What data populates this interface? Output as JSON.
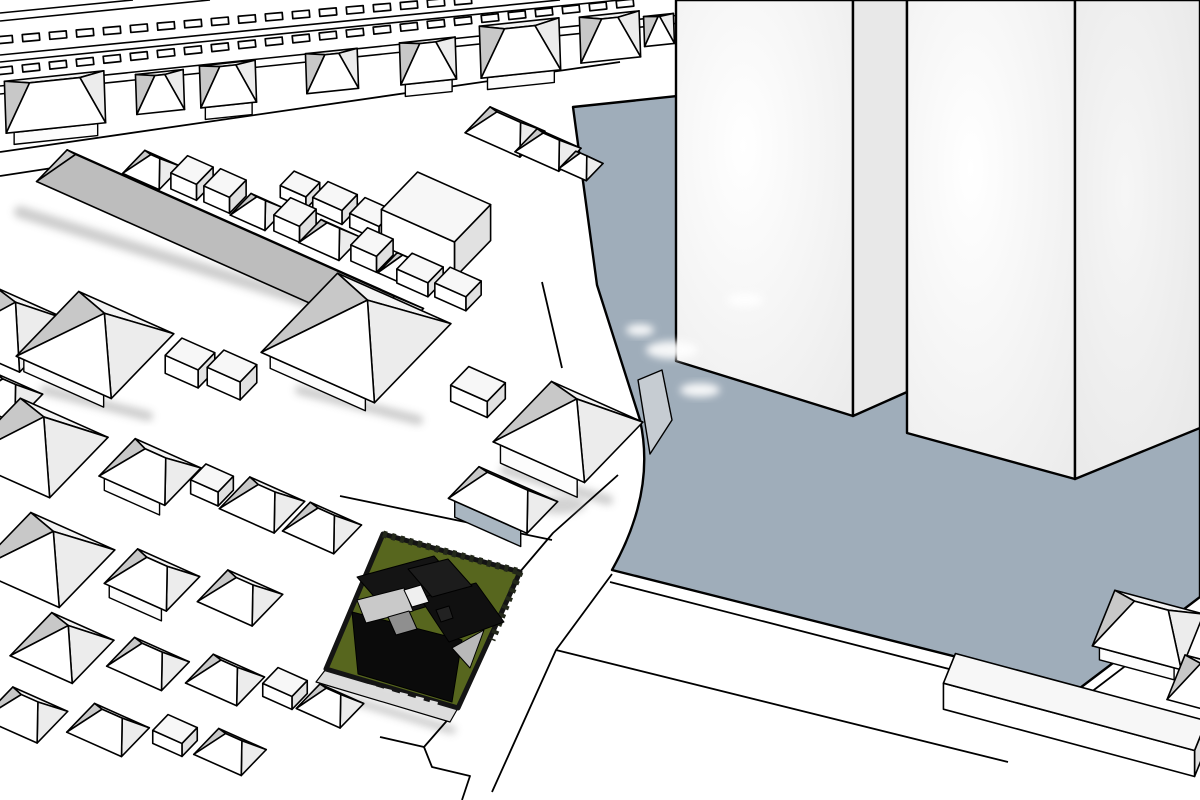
{
  "meta": {
    "kind": "3d-site-model-rendering",
    "description_visible_text": ""
  },
  "palette": {
    "background": "#ffffff",
    "line": "#000000",
    "roof_white": "#ffffff",
    "roof_back": "#f3f3f3",
    "roof_left_shade": "#c8c8c8",
    "roof_right_shade": "#ececec",
    "roof_gray_front": "#bdbdbd",
    "wall_white": "#fcfcfc",
    "wall_blue": "#a9b6c1",
    "box_top": "#f7f7f7",
    "box_front": "#ffffff",
    "box_side": "#e1e1e1",
    "plot_blue": "#9fadba",
    "apron_gray": "#c6ccd2",
    "lot_green": "#57661e",
    "lot_border": "#141414",
    "lot_curb": "#dcdcdc",
    "tower_bright_a": "#ffffff",
    "tower_bright_b": "#ececec",
    "tower_side_a": "#f6f6f6",
    "tower_side_b": "#e6e6e6",
    "tower_flat_side": "#e8e8e8",
    "shadow_gray": "#8f8f8f",
    "dark_building": "#0b0b0b"
  },
  "scene": {
    "width": 1200,
    "height": 800,
    "zones": {
      "R": {
        "p": -6,
        "q": 88
      },
      "M": {
        "p": 24,
        "q": 134
      },
      "L": {
        "p": 15,
        "q": 112
      }
    },
    "railway": {
      "rails": [
        [
          0,
          13,
          133,
          0
        ],
        [
          0,
          21,
          210,
          0
        ],
        [
          0,
          55,
          560,
          0
        ],
        [
          0,
          62,
          620,
          0
        ],
        [
          0,
          86,
          690,
          14
        ],
        [
          0,
          94,
          690,
          22
        ]
      ],
      "tie_rows": [
        {
          "x0": 4,
          "x1": 470,
          "step": 27,
          "y0": 40,
          "slope": -0.085,
          "w": 17,
          "h": 7,
          "ang": -5
        },
        {
          "x0": 4,
          "x1": 648,
          "step": 27,
          "y0": 71,
          "slope": -0.108,
          "w": 17,
          "h": 7,
          "ang": -6
        }
      ]
    },
    "plot": {
      "path": "M573,107 L1200,41 L1200,597 L1080,688 L612,570 Q656,492 640,420 L597,285 Z"
    },
    "apron": [
      [
        638,
        380
      ],
      [
        662,
        370
      ],
      [
        672,
        420
      ],
      [
        650,
        454
      ]
    ],
    "towers": [
      {
        "pts": [
          [
            676,
            0
          ],
          [
            853,
            0
          ],
          [
            853,
            416
          ],
          [
            676,
            361
          ]
        ],
        "fill": "grad_front"
      },
      {
        "pts": [
          [
            853,
            0
          ],
          [
            907,
            0
          ],
          [
            907,
            392
          ],
          [
            853,
            416
          ]
        ],
        "fill": "flat_side"
      },
      {
        "pts": [
          [
            907,
            0
          ],
          [
            1075,
            0
          ],
          [
            1075,
            479
          ],
          [
            907,
            433
          ]
        ],
        "fill": "grad_front"
      },
      {
        "pts": [
          [
            1075,
            0
          ],
          [
            1200,
            0
          ],
          [
            1200,
            428
          ],
          [
            1075,
            479
          ]
        ],
        "fill": "grad_side"
      }
    ],
    "street_lines": [
      "M0,152 L620,62",
      "M0,176 L85,163 L88,195",
      "M542,282 L562,368",
      "M618,475 L553,533 L519,573",
      "M458,708 L424,747 L432,767 L470,776 L462,800",
      "M380,737 L424,747",
      "M612,574 L556,650 L492,792",
      "M556,650 L1008,762",
      "M610,582 L1070,700",
      "M340,496 L552,540",
      "M1086,696 L1196,612"
    ],
    "shadow_lines": [
      [
        20,
        212,
        400,
        330,
        12
      ],
      [
        45,
        390,
        148,
        416,
        10
      ],
      [
        300,
        390,
        418,
        420,
        10
      ],
      [
        505,
        470,
        608,
        500,
        10
      ],
      [
        318,
        690,
        452,
        730,
        8
      ]
    ],
    "white_blobs": [
      [
        672,
        350,
        26,
        9
      ],
      [
        745,
        300,
        18,
        7
      ],
      [
        700,
        390,
        20,
        7
      ],
      [
        640,
        330,
        14,
        6
      ]
    ],
    "gray_blobs": [
      [
        560,
        505,
        26,
        9
      ]
    ],
    "houses": [
      [
        55,
        102,
        50,
        26,
        14,
        "hip",
        "R",
        1,
        ""
      ],
      [
        160,
        92,
        24,
        20,
        11,
        "hip",
        "R",
        0,
        ""
      ],
      [
        228,
        84,
        28,
        21,
        12,
        "hip",
        "R",
        1,
        ""
      ],
      [
        332,
        71,
        26,
        20,
        11,
        "hip",
        "R",
        0,
        ""
      ],
      [
        428,
        61,
        28,
        21,
        12,
        "hip",
        "R",
        1,
        ""
      ],
      [
        520,
        48,
        40,
        26,
        13,
        "hip",
        "R",
        1,
        ""
      ],
      [
        610,
        37,
        30,
        23,
        12,
        "hip",
        "R",
        0,
        ""
      ],
      [
        659,
        30,
        15,
        15,
        9,
        "hip",
        "R",
        0,
        ""
      ],
      [
        152,
        170,
        20,
        16,
        10,
        "hip",
        "M",
        0,
        ""
      ],
      [
        192,
        186,
        14,
        12,
        16,
        "box",
        "M",
        0,
        ""
      ],
      [
        225,
        199,
        14,
        12,
        16,
        "box",
        "M",
        0,
        ""
      ],
      [
        258,
        212,
        19,
        15,
        10,
        "hip",
        "M",
        0,
        ""
      ],
      [
        295,
        228,
        14,
        12,
        16,
        "box",
        "M",
        0,
        ""
      ],
      [
        330,
        240,
        22,
        16,
        11,
        "hip",
        "M",
        0,
        ""
      ],
      [
        372,
        258,
        14,
        12,
        16,
        "box",
        "M",
        0,
        ""
      ],
      [
        404,
        270,
        18,
        14,
        10,
        "hip",
        "M",
        0,
        ""
      ],
      [
        230,
        245,
        195,
        22,
        15,
        "hip",
        "M",
        0,
        "grayfront",
        300
      ],
      [
        300,
        196,
        14,
        10,
        12,
        "box",
        "M",
        0,
        ""
      ],
      [
        335,
        210,
        16,
        11,
        14,
        "box",
        "M",
        0,
        ""
      ],
      [
        372,
        226,
        16,
        11,
        14,
        "box",
        "M",
        0,
        ""
      ],
      [
        436,
        243,
        40,
        26,
        36,
        "box",
        "M",
        0,
        ""
      ],
      [
        505,
        132,
        30,
        18,
        11,
        "hip",
        "M",
        0,
        ""
      ],
      [
        548,
        150,
        24,
        16,
        10,
        "hip",
        "M",
        0,
        ""
      ],
      [
        581,
        166,
        15,
        12,
        9,
        "hip",
        "M",
        0,
        ""
      ],
      [
        420,
        282,
        17,
        11,
        14,
        "box",
        "M",
        0,
        ""
      ],
      [
        458,
        296,
        17,
        11,
        14,
        "box",
        "M",
        0,
        ""
      ],
      [
        95,
        345,
        52,
        45,
        22,
        "pyr",
        "M",
        1,
        ""
      ],
      [
        356,
        338,
        62,
        55,
        26,
        "pyr",
        "M",
        1,
        ""
      ],
      [
        190,
        372,
        18,
        12,
        18,
        "box",
        "M",
        0,
        ""
      ],
      [
        232,
        384,
        18,
        12,
        18,
        "box",
        "M",
        0,
        ""
      ],
      [
        8,
        330,
        40,
        36,
        20,
        "pyr",
        "M",
        0,
        ""
      ],
      [
        5,
        398,
        26,
        20,
        12,
        "hip",
        "M",
        0,
        ""
      ],
      [
        35,
        448,
        48,
        42,
        22,
        "pyr",
        "M",
        0,
        ""
      ],
      [
        150,
        472,
        36,
        26,
        13,
        "hip",
        "M",
        1,
        ""
      ],
      [
        212,
        492,
        15,
        11,
        14,
        "box",
        "M",
        0,
        ""
      ],
      [
        262,
        505,
        30,
        22,
        12,
        "hip",
        "M",
        0,
        ""
      ],
      [
        478,
        400,
        20,
        13,
        16,
        "box",
        "M",
        0,
        ""
      ],
      [
        568,
        432,
        50,
        42,
        24,
        "pyr",
        "M",
        1,
        "tallwall"
      ],
      [
        503,
        500,
        43,
        22,
        14,
        "hip",
        "M",
        1,
        "bluewall"
      ],
      [
        45,
        560,
        46,
        40,
        20,
        "pyr",
        "M",
        0,
        ""
      ],
      [
        152,
        580,
        34,
        24,
        13,
        "hip",
        "M",
        1,
        ""
      ],
      [
        240,
        598,
        30,
        22,
        12,
        "hip",
        "M",
        0,
        ""
      ],
      [
        322,
        528,
        28,
        20,
        12,
        "hip",
        "M",
        0,
        ""
      ],
      [
        62,
        648,
        34,
        30,
        16,
        "pyr",
        "M",
        0,
        ""
      ],
      [
        148,
        664,
        30,
        20,
        12,
        "hip",
        "M",
        0,
        ""
      ],
      [
        225,
        680,
        28,
        20,
        12,
        "hip",
        "M",
        0,
        ""
      ],
      [
        285,
        695,
        16,
        11,
        13,
        "box",
        "M",
        0,
        ""
      ],
      [
        330,
        706,
        24,
        17,
        11,
        "hip",
        "M",
        0,
        "",
        700
      ],
      [
        25,
        715,
        30,
        22,
        12,
        "hip",
        "M",
        0,
        "",
        700
      ],
      [
        108,
        730,
        30,
        20,
        12,
        "hip",
        "M",
        0,
        "",
        700
      ],
      [
        175,
        742,
        16,
        11,
        13,
        "box",
        "M",
        0,
        "",
        700
      ],
      [
        230,
        752,
        26,
        18,
        11,
        "hip",
        "M",
        0,
        "",
        700
      ],
      [
        1148,
        630,
        46,
        30,
        16,
        "hip",
        "L",
        1,
        "",
        700
      ],
      [
        1205,
        685,
        30,
        24,
        13,
        "hip",
        "L",
        0,
        "",
        700
      ],
      [
        1075,
        728,
        130,
        16,
        26,
        "box",
        "L",
        0,
        "",
        700
      ]
    ],
    "lot": {
      "quad": [
        [
          383,
          534
        ],
        [
          520,
          572
        ],
        [
          458,
          708
        ],
        [
          326,
          669
        ]
      ],
      "curb": [
        [
          326,
          669
        ],
        [
          458,
          708
        ],
        [
          450,
          722
        ],
        [
          316,
          682
        ]
      ],
      "hedges": [
        "M383,534 L520,572",
        "M520,572 L492,640"
      ]
    },
    "dark_house": {
      "polys": [
        {
          "pts": [
            [
              352,
              612
            ],
            [
              462,
              640
            ],
            [
              452,
              702
            ],
            [
              358,
              674
            ]
          ],
          "fill": "#0b0b0b"
        },
        {
          "pts": [
            [
              357,
              577
            ],
            [
              434,
              556
            ],
            [
              468,
              594
            ],
            [
              392,
              617
            ]
          ],
          "fill": "#141414"
        },
        {
          "pts": [
            [
              420,
              598
            ],
            [
              476,
              583
            ],
            [
              504,
              622
            ],
            [
              449,
              642
            ]
          ],
          "fill": "#101010"
        },
        {
          "pts": [
            [
              408,
              569
            ],
            [
              448,
              559
            ],
            [
              472,
              586
            ],
            [
              432,
              597
            ]
          ],
          "fill": "#1c1c1c"
        },
        {
          "pts": [
            [
              357,
              600
            ],
            [
              404,
              588
            ],
            [
              413,
              611
            ],
            [
              366,
              623
            ]
          ],
          "fill": "#c9c9c9"
        },
        {
          "pts": [
            [
              404,
              590
            ],
            [
              421,
              585
            ],
            [
              429,
              602
            ],
            [
              412,
              607
            ]
          ],
          "fill": "#efefef"
        },
        {
          "pts": [
            [
              388,
              617
            ],
            [
              409,
              611
            ],
            [
              417,
              629
            ],
            [
              396,
              635
            ]
          ],
          "fill": "#8f8f8f"
        },
        {
          "pts": [
            [
              452,
              648
            ],
            [
              484,
              630
            ],
            [
              470,
              668
            ]
          ],
          "fill": "#b9b9b9"
        },
        {
          "pts": [
            [
              436,
              610
            ],
            [
              449,
              606
            ],
            [
              453,
              618
            ],
            [
              441,
              622
            ]
          ],
          "fill": "#222222"
        }
      ],
      "windows": [
        [
          368,
          684
        ],
        [
          384,
          688
        ],
        [
          400,
          692
        ],
        [
          416,
          696
        ],
        [
          430,
          700
        ]
      ]
    }
  }
}
